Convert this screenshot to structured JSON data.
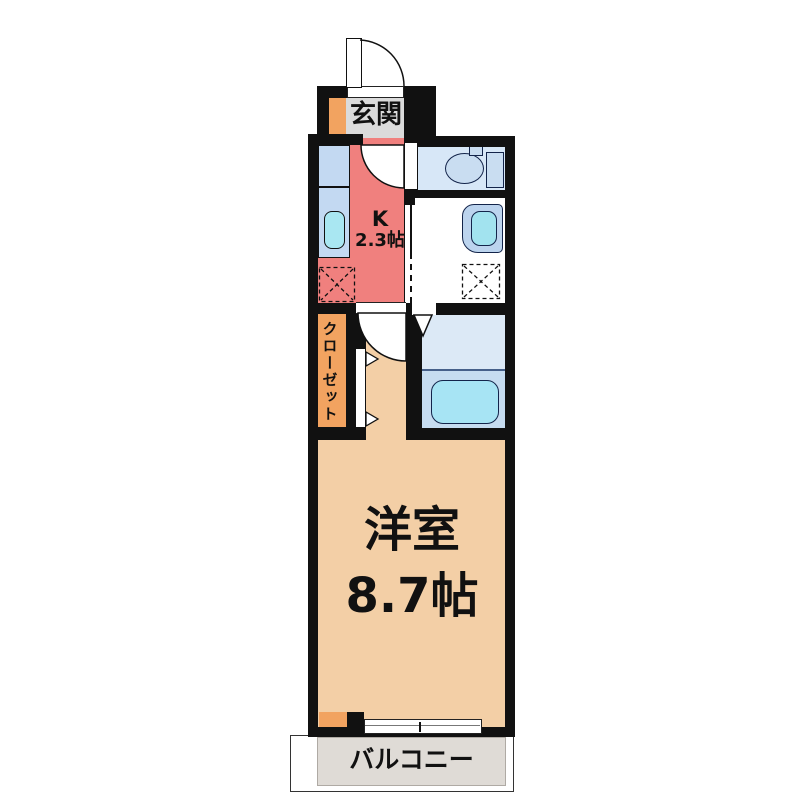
{
  "floorplan": {
    "rooms": {
      "genkan": {
        "label": "玄関"
      },
      "kitchen": {
        "label_line1": "K",
        "label_line2": "2.3帖"
      },
      "closet": {
        "label": "クローゼット"
      },
      "western_room": {
        "label_line1": "洋室",
        "label_line2": "8.7帖"
      },
      "balcony": {
        "label": "バルコニー"
      }
    },
    "fixtures": [
      "entry-door",
      "shoe-cabinet",
      "kitchen-counter",
      "kitchen-sink",
      "refrigerator-space",
      "toilet",
      "washbasin",
      "washing-machine-space",
      "bathtub",
      "closet-folding-door",
      "sliding-window"
    ],
    "colors": {
      "wall": "#111111",
      "kitchen_floor": "#F0807E",
      "room_floor": "#F3CFA6",
      "genkan_floor": "#DBDBDB",
      "closet_fill": "#F2A360",
      "toilet_floor": "#D7E7F7",
      "bath_floor_upper": "#DCE9F6",
      "bath_floor_lower": "#C6DCF0",
      "counter_blue": "#C3D9F2",
      "water_cyan": "#A9E7F2",
      "balcony_floor": "#DFDBD6"
    }
  }
}
